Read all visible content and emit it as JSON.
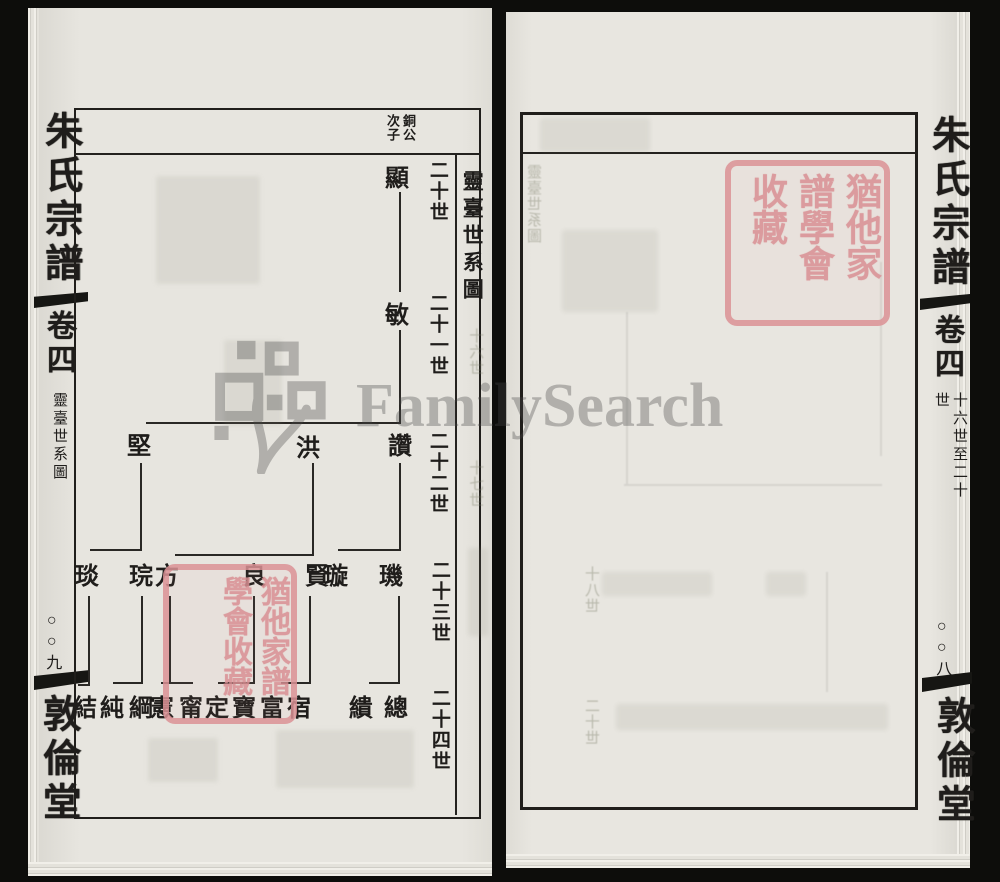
{
  "scan": {
    "watermark": {
      "text": "FamilySearch",
      "logo": "familysearch-tree-logo",
      "color": "#707070"
    },
    "seal": {
      "text": "猶他家譜學會收藏",
      "color": "#dc9296"
    }
  },
  "left_page": {
    "spine": {
      "book_title": "朱氏宗譜",
      "volume": "卷四",
      "section_title": "靈臺世系圖",
      "page_number": "○○九",
      "hall_name": "敦倫堂"
    },
    "chart": {
      "title": "靈臺世系圖",
      "annotation": "銅公次子",
      "generations": [
        {
          "label": "二十世",
          "x": 398,
          "y": 152
        },
        {
          "label": "二十一世",
          "x": 398,
          "y": 285
        },
        {
          "label": "二十二世",
          "x": 398,
          "y": 423
        },
        {
          "label": "二十三世",
          "x": 400,
          "y": 552
        },
        {
          "label": "二十四世",
          "x": 400,
          "y": 680
        }
      ],
      "nodes": [
        {
          "name": "顯",
          "generation": "二十世",
          "x": 369,
          "y": 158
        },
        {
          "name": "敏",
          "generation": "二十一世",
          "x": 369,
          "y": 295
        },
        {
          "name": "讚",
          "generation": "二十二世",
          "x": 372,
          "y": 426
        },
        {
          "name": "洪",
          "generation": "二十二世",
          "x": 280,
          "y": 428
        },
        {
          "name": "堅",
          "generation": "二十二世",
          "x": 111,
          "y": 426
        },
        {
          "name": "璣",
          "generation": "二十三世",
          "x": 363,
          "y": 556
        },
        {
          "name": "璇",
          "generation": "二十三世",
          "x": 308,
          "y": 556
        },
        {
          "name": "賢",
          "generation": "二十三世",
          "x": 289,
          "y": 556
        },
        {
          "name": "良",
          "generation": "二十三世",
          "x": 226,
          "y": 556
        },
        {
          "name": "方",
          "generation": "二十三世",
          "x": 139,
          "y": 556
        },
        {
          "name": "琓",
          "generation": "二十三世",
          "x": 113,
          "y": 556
        },
        {
          "name": "琰",
          "generation": "二十三世",
          "x": 59,
          "y": 556
        },
        {
          "name": "總",
          "generation": "二十四世",
          "x": 368,
          "y": 688
        },
        {
          "name": "繢",
          "generation": "二十四世",
          "x": 333,
          "y": 688
        },
        {
          "name": "宿",
          "generation": "二十四世",
          "x": 271,
          "y": 688
        },
        {
          "name": "富",
          "generation": "二十四世",
          "x": 244,
          "y": 688
        },
        {
          "name": "寶",
          "generation": "二十四世",
          "x": 216,
          "y": 688
        },
        {
          "name": "定",
          "generation": "二十四世",
          "x": 189,
          "y": 688
        },
        {
          "name": "甯",
          "generation": "二十四世",
          "x": 163,
          "y": 688
        },
        {
          "name": "憲",
          "generation": "二十四世",
          "x": 134,
          "y": 688
        },
        {
          "name": "綱",
          "generation": "二十四世",
          "x": 113,
          "y": 688
        },
        {
          "name": "純",
          "generation": "二十四世",
          "x": 84,
          "y": 688
        },
        {
          "name": "結",
          "generation": "二十四世",
          "x": 57,
          "y": 688
        }
      ],
      "edges": [
        [
          371,
          184,
          2,
          100
        ],
        [
          371,
          322,
          2,
          92
        ],
        [
          118,
          414,
          255,
          2
        ],
        [
          371,
          455,
          2,
          86
        ],
        [
          310,
          541,
          63,
          2
        ],
        [
          284,
          455,
          2,
          91
        ],
        [
          147,
          546,
          139,
          2
        ],
        [
          112,
          455,
          2,
          86
        ],
        [
          62,
          541,
          52,
          2
        ],
        [
          370,
          588,
          2,
          86
        ],
        [
          341,
          674,
          31,
          2
        ],
        [
          281,
          588,
          2,
          86
        ],
        [
          253,
          674,
          30,
          2
        ],
        [
          225,
          588,
          2,
          86
        ],
        [
          190,
          674,
          37,
          2
        ],
        [
          141,
          588,
          2,
          86
        ],
        [
          133,
          674,
          32,
          2
        ],
        [
          113,
          588,
          2,
          86
        ],
        [
          85,
          674,
          30,
          2
        ],
        [
          60,
          588,
          2,
          88
        ],
        [
          50,
          676,
          12,
          2
        ]
      ]
    },
    "ghost_labels": [
      {
        "text": "十六世",
        "x": 438,
        "y": 320
      },
      {
        "text": "十七世",
        "x": 438,
        "y": 452
      }
    ]
  },
  "right_page": {
    "spine": {
      "book_title": "朱氏宗譜",
      "volume": "卷四",
      "generation_range": "十六世至二十世",
      "page_number": "○○八",
      "hall_name": "敦倫堂"
    },
    "ghost_labels": [
      {
        "text": "靈臺世系圖",
        "x": 22,
        "y": 152,
        "mirror": true
      },
      {
        "text": "十八世",
        "x": 80,
        "y": 554,
        "mirror": true
      },
      {
        "text": "二十世",
        "x": 80,
        "y": 686,
        "mirror": true
      }
    ]
  }
}
